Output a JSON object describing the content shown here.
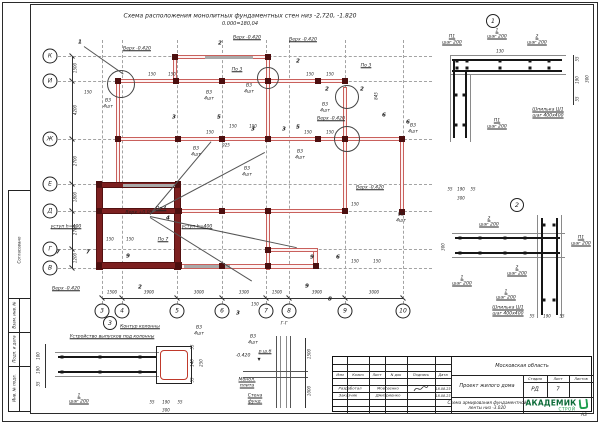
{
  "sheet": {
    "format": "А3"
  },
  "header": {
    "title_line1": "Схема расположения монолитных фундаментных стен низ -2,720, -1.820",
    "title_line2": "0.000=180,04"
  },
  "side_strip": {
    "cells": [
      "Согласовано",
      "Взам. инв. №",
      "Подп. и дата",
      "Инв. № подл."
    ]
  },
  "plan": {
    "axes_left": [
      {
        "label": "К",
        "y": 56
      },
      {
        "label": "И",
        "y": 81
      },
      {
        "label": "Ж",
        "y": 139
      },
      {
        "label": "Е",
        "y": 184
      },
      {
        "label": "Д",
        "y": 211
      },
      {
        "label": "Г",
        "y": 249
      },
      {
        "label": "В",
        "y": 268
      }
    ],
    "axes_bottom": [
      {
        "label": "3",
        "x": 102
      },
      {
        "label": "4",
        "x": 122
      },
      {
        "label": "5",
        "x": 177
      },
      {
        "label": "6",
        "x": 222
      },
      {
        "label": "7",
        "x": 266
      },
      {
        "label": "8",
        "x": 289
      },
      {
        "label": "9",
        "x": 345
      },
      {
        "label": "10",
        "x": 403
      }
    ],
    "dims_left": [
      {
        "t": "1500",
        "y": 68
      },
      {
        "t": "4200",
        "y": 110
      },
      {
        "t": "2700",
        "y": 161
      },
      {
        "t": "1800",
        "y": 197
      },
      {
        "t": "2700",
        "y": 230
      },
      {
        "t": "1200",
        "y": 258
      }
    ],
    "dims_bottom": [
      {
        "t": "1500",
        "x": 112
      },
      {
        "t": "3900",
        "x": 149
      },
      {
        "t": "3000",
        "x": 199
      },
      {
        "t": "3300",
        "x": 244
      },
      {
        "t": "1500",
        "x": 277
      },
      {
        "t": "3900",
        "x": 317
      },
      {
        "t": "3000",
        "x": 374
      }
    ]
  },
  "labels": [
    {
      "t": "Верх -0.420",
      "x": 137,
      "y": 49,
      "u": 1
    },
    {
      "t": "Верх -0.420",
      "x": 247,
      "y": 38,
      "u": 1
    },
    {
      "t": "Верх -0.420",
      "x": 303,
      "y": 40,
      "u": 1
    },
    {
      "t": "Верх -0.420",
      "x": 331,
      "y": 119,
      "u": 1
    },
    {
      "t": "Верх -0.420",
      "x": 370,
      "y": 188,
      "u": 1
    },
    {
      "t": "Верх -0.420",
      "x": 66,
      "y": 289,
      "u": 1
    },
    {
      "t": "Верх +0.05",
      "x": 139,
      "y": 213
    },
    {
      "t": "По 4",
      "x": 161,
      "y": 209,
      "u": 1
    },
    {
      "t": "По 3",
      "x": 237,
      "y": 70,
      "u": 1
    },
    {
      "t": "По 3",
      "x": 366,
      "y": 66,
      "u": 1
    },
    {
      "t": "По 7",
      "x": 163,
      "y": 240,
      "u": 1
    },
    {
      "t": "В3\n4шт",
      "x": 108,
      "y": 104
    },
    {
      "t": "В3\n4шт",
      "x": 209,
      "y": 96
    },
    {
      "t": "В3\n4шт",
      "x": 249,
      "y": 89
    },
    {
      "t": "В3\n4шт",
      "x": 325,
      "y": 108
    },
    {
      "t": "В3\n4шт",
      "x": 196,
      "y": 152
    },
    {
      "t": "В3\n4шт",
      "x": 300,
      "y": 155
    },
    {
      "t": "В3\n4шт",
      "x": 413,
      "y": 129
    },
    {
      "t": "В3\n4шт",
      "x": 401,
      "y": 218
    },
    {
      "t": "В3\n4шт",
      "x": 247,
      "y": 172
    },
    {
      "t": "уступ h=400",
      "x": 66,
      "y": 227,
      "u": 1
    },
    {
      "t": "уступ h=400",
      "x": 197,
      "y": 227,
      "u": 1
    },
    {
      "t": "150",
      "x": 152,
      "y": 75,
      "s": 1
    },
    {
      "t": "150",
      "x": 172,
      "y": 75,
      "s": 1
    },
    {
      "t": "150",
      "x": 88,
      "y": 93,
      "s": 1
    },
    {
      "t": "150",
      "x": 310,
      "y": 75,
      "s": 1
    },
    {
      "t": "150",
      "x": 330,
      "y": 75,
      "s": 1
    },
    {
      "t": "150",
      "x": 233,
      "y": 127,
      "s": 1
    },
    {
      "t": "150",
      "x": 253,
      "y": 127,
      "s": 1
    },
    {
      "t": "150",
      "x": 210,
      "y": 133,
      "s": 1
    },
    {
      "t": "150",
      "x": 308,
      "y": 133,
      "s": 1
    },
    {
      "t": "150",
      "x": 330,
      "y": 133,
      "s": 1
    },
    {
      "t": "150",
      "x": 110,
      "y": 240,
      "s": 1
    },
    {
      "t": "150",
      "x": 130,
      "y": 240,
      "s": 1
    },
    {
      "t": "150",
      "x": 355,
      "y": 205,
      "s": 1
    },
    {
      "t": "150",
      "x": 355,
      "y": 262,
      "s": 1
    },
    {
      "t": "150",
      "x": 377,
      "y": 262,
      "s": 1
    },
    {
      "t": "150",
      "x": 255,
      "y": 305,
      "s": 1
    },
    {
      "t": "925",
      "x": 226,
      "y": 146,
      "s": 1
    },
    {
      "t": "845",
      "x": 377,
      "y": 96,
      "r": 1,
      "s": 1
    },
    {
      "t": "1",
      "x": 80,
      "y": 43,
      "b": 1
    },
    {
      "t": "2",
      "x": 220,
      "y": 44,
      "b": 1
    },
    {
      "t": "2",
      "x": 298,
      "y": 62,
      "b": 1
    },
    {
      "t": "2",
      "x": 327,
      "y": 90,
      "b": 1
    },
    {
      "t": "2",
      "x": 362,
      "y": 90,
      "b": 1
    },
    {
      "t": "3",
      "x": 174,
      "y": 118,
      "b": 1
    },
    {
      "t": "5",
      "x": 219,
      "y": 118,
      "b": 1
    },
    {
      "t": "3",
      "x": 253,
      "y": 130,
      "b": 1
    },
    {
      "t": "3",
      "x": 284,
      "y": 130,
      "b": 1
    },
    {
      "t": "5",
      "x": 298,
      "y": 128,
      "b": 1
    },
    {
      "t": "6",
      "x": 384,
      "y": 116,
      "b": 1
    },
    {
      "t": "6",
      "x": 408,
      "y": 123,
      "b": 1
    },
    {
      "t": "7",
      "x": 58,
      "y": 253,
      "b": 1
    },
    {
      "t": "7",
      "x": 88,
      "y": 253,
      "b": 1
    },
    {
      "t": "9",
      "x": 128,
      "y": 257,
      "b": 1
    },
    {
      "t": "9",
      "x": 312,
      "y": 258,
      "b": 1
    },
    {
      "t": "6",
      "x": 338,
      "y": 258,
      "b": 1
    },
    {
      "t": "3",
      "x": 238,
      "y": 314,
      "b": 1
    },
    {
      "t": "8",
      "x": 330,
      "y": 300,
      "b": 1
    },
    {
      "t": "9",
      "x": 307,
      "y": 287,
      "b": 1
    },
    {
      "t": "4",
      "x": 168,
      "y": 219,
      "b": 1
    },
    {
      "t": "2",
      "x": 140,
      "y": 288,
      "b": 1
    },
    {
      "t": "1",
      "x": 493,
      "y": 21,
      "c": "bub"
    },
    {
      "t": "П1\nшаг 200",
      "x": 452,
      "y": 40,
      "u": 1
    },
    {
      "t": "1\nшаг 200",
      "x": 497,
      "y": 34,
      "u": 1
    },
    {
      "t": "2\nшаг 200",
      "x": 537,
      "y": 40,
      "u": 1
    },
    {
      "t": "130",
      "x": 500,
      "y": 52,
      "s": 1
    },
    {
      "t": "55",
      "x": 578,
      "y": 59,
      "r": 1,
      "s": 1
    },
    {
      "t": "190",
      "x": 578,
      "y": 80,
      "r": 1,
      "s": 1
    },
    {
      "t": "55",
      "x": 578,
      "y": 99,
      "r": 1,
      "s": 1
    },
    {
      "t": "300",
      "x": 588,
      "y": 79,
      "r": 1,
      "s": 1
    },
    {
      "t": "П1\nшаг 200",
      "x": 497,
      "y": 124,
      "u": 1
    },
    {
      "t": "Шпилька Ш1\nшаг 400х400",
      "x": 548,
      "y": 113,
      "u": 1
    },
    {
      "t": "55",
      "x": 450,
      "y": 190,
      "s": 1
    },
    {
      "t": "190",
      "x": 461,
      "y": 190,
      "s": 1
    },
    {
      "t": "55",
      "x": 473,
      "y": 190,
      "s": 1
    },
    {
      "t": "300",
      "x": 461,
      "y": 199,
      "s": 1
    },
    {
      "t": "2",
      "x": 517,
      "y": 205,
      "c": "bub"
    },
    {
      "t": "2\nшаг 200",
      "x": 489,
      "y": 222,
      "u": 1
    },
    {
      "t": "П1\nшаг 200",
      "x": 581,
      "y": 241,
      "u": 1
    },
    {
      "t": "2\nшаг 200",
      "x": 517,
      "y": 271,
      "u": 1
    },
    {
      "t": "1\nшаг 200",
      "x": 462,
      "y": 281,
      "u": 1
    },
    {
      "t": "1\nшаг 200",
      "x": 506,
      "y": 295,
      "u": 1
    },
    {
      "t": "Шпилька Ш1\nшаг 400х400",
      "x": 508,
      "y": 311,
      "u": 1
    },
    {
      "t": "55",
      "x": 532,
      "y": 317,
      "s": 1
    },
    {
      "t": "190",
      "x": 547,
      "y": 317,
      "s": 1
    },
    {
      "t": "55",
      "x": 562,
      "y": 317,
      "s": 1
    },
    {
      "t": "300",
      "x": 444,
      "y": 247,
      "r": 1,
      "s": 1
    },
    {
      "t": "3",
      "x": 110,
      "y": 323,
      "c": "bub"
    },
    {
      "t": "Устройство выпусков под колонны",
      "x": 112,
      "y": 337,
      "u": 1
    },
    {
      "t": "Контур колонны",
      "x": 140,
      "y": 327,
      "u": 1
    },
    {
      "t": "В3\n4шт",
      "x": 199,
      "y": 331
    },
    {
      "t": "1\nшаг 200",
      "x": 79,
      "y": 399,
      "u": 1
    },
    {
      "t": "100",
      "x": 39,
      "y": 356,
      "r": 1,
      "s": 1
    },
    {
      "t": "190",
      "x": 39,
      "y": 370,
      "r": 1,
      "s": 1
    },
    {
      "t": "55",
      "x": 39,
      "y": 384,
      "r": 1,
      "s": 1
    },
    {
      "t": "55",
      "x": 193,
      "y": 347,
      "r": 1,
      "s": 1
    },
    {
      "t": "140",
      "x": 193,
      "y": 363,
      "r": 1,
      "s": 1
    },
    {
      "t": "55",
      "x": 193,
      "y": 380,
      "r": 1,
      "s": 1
    },
    {
      "t": "250",
      "x": 202,
      "y": 363,
      "r": 1,
      "s": 1
    },
    {
      "t": "55",
      "x": 152,
      "y": 403,
      "s": 1
    },
    {
      "t": "190",
      "x": 166,
      "y": 403,
      "s": 1
    },
    {
      "t": "55",
      "x": 180,
      "y": 403,
      "s": 1
    },
    {
      "t": "300",
      "x": 166,
      "y": 411,
      "s": 1
    },
    {
      "t": "Г-Г",
      "x": 284,
      "y": 324
    },
    {
      "t": "В3\n4шт",
      "x": 253,
      "y": 340
    },
    {
      "t": "р.ш.б",
      "x": 265,
      "y": 352,
      "u": 1
    },
    {
      "t": "-0.420",
      "x": 243,
      "y": 356
    },
    {
      "t": "▼",
      "x": 259,
      "y": 360,
      "s": 1
    },
    {
      "t": "Монол.\nплита",
      "x": 247,
      "y": 383,
      "u": 1
    },
    {
      "t": "Стена\nфунд.",
      "x": 255,
      "y": 399,
      "u": 1
    },
    {
      "t": "1500",
      "x": 310,
      "y": 354,
      "r": 1,
      "s": 1
    },
    {
      "t": "1000",
      "x": 310,
      "y": 391,
      "r": 1,
      "s": 1
    }
  ],
  "stamp": {
    "region": "Московская область",
    "project": "Проект жилого дома",
    "sheet_title": "Схема армирования фундаментной\nленты низ -3.020",
    "stage_label": "Стадия",
    "sheet_label": "Лист",
    "sheets_label": "Листов",
    "stage": "РД",
    "sheet_no": "7",
    "header_cols": [
      "Изм",
      "Колич",
      "Лист",
      "N док",
      "Подпись",
      "Дата"
    ],
    "rows": [
      {
        "role": "Разработал",
        "name": "Мовсеенко",
        "date": "18.08.23"
      },
      {
        "role": "Заказчик",
        "name": "Дмитриенко",
        "date": "18.08.23"
      }
    ],
    "logo_top": "АКАДЕМИК",
    "logo_bottom": "СТРОЙ",
    "brand_green": "#1f9e4f",
    "brand_dark_green": "#0c6b38"
  }
}
